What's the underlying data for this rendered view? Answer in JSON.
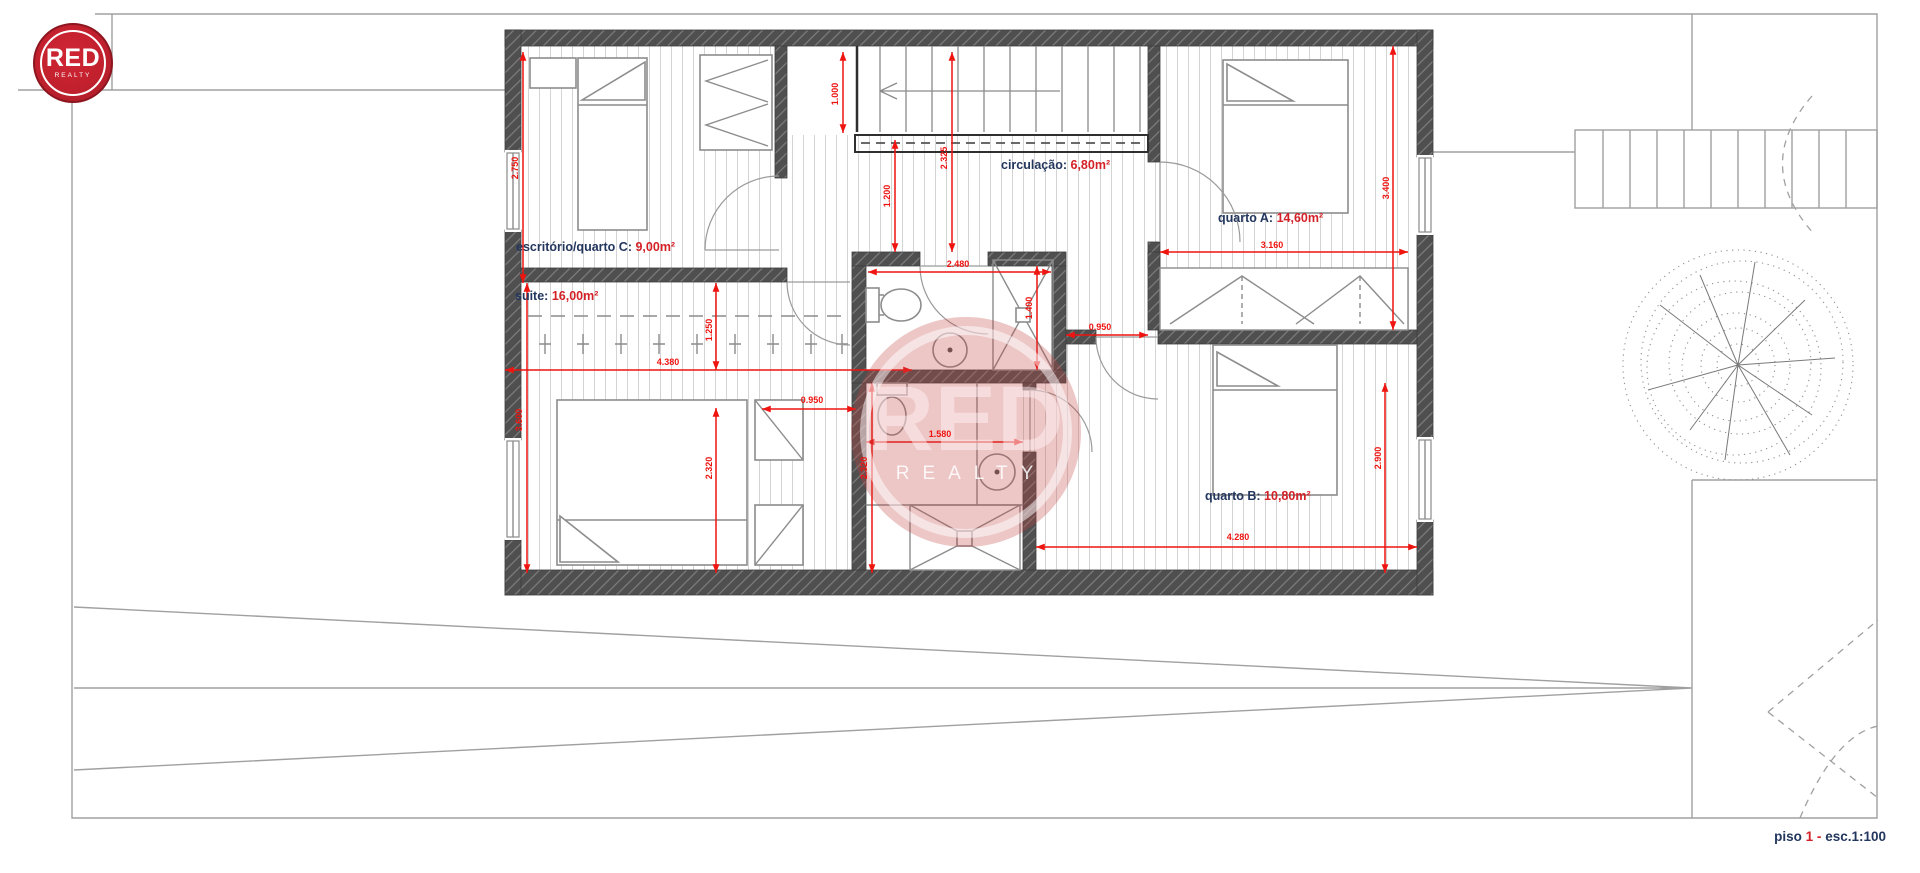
{
  "logo": {
    "title": "RED",
    "subtitle": "REALTY"
  },
  "watermark": {
    "title": "RED",
    "subtitle": "REALTY"
  },
  "footer": {
    "label": "piso",
    "number": "1",
    "separator": "-",
    "scale": "esc.1:100"
  },
  "rooms": {
    "escritorio": {
      "name": "escritório/quarto C:",
      "area": "9,00m²"
    },
    "circulacao": {
      "name": "circulação:",
      "area": "6,80m²"
    },
    "quarto_a": {
      "name": "quarto A:",
      "area": "14,60m²"
    },
    "suite": {
      "name": "suite:",
      "area": "16,00m²"
    },
    "quarto_b": {
      "name": "quarto B:",
      "area": "10,80m²"
    }
  },
  "dimensions": {
    "room_c_height": "2.750",
    "landing_width": "1.000",
    "circulation_width": "1.200",
    "hall_depth": "2.325",
    "bath1_width": "2.480",
    "shower_depth": "1.400",
    "corridor_width": "0.950",
    "wardrobe_width": "3.160",
    "quarto_a_depth": "3.400",
    "quarto_b_depth": "2.900",
    "quarto_b_width": "4.280",
    "suite_width": "4.380",
    "suite_depth": "3.600",
    "closet_depth": "1.250",
    "suite_bed_zone": "2.320",
    "entry_nook": "0.950",
    "bath2_width": "1.580",
    "bath2_depth": "2.320"
  },
  "colors": {
    "label_navy": "#23365e",
    "label_red": "#d42127",
    "dim_red": "#ee1410",
    "wall_gray": "#4f4f4f",
    "logo_red": "#c2202e"
  }
}
